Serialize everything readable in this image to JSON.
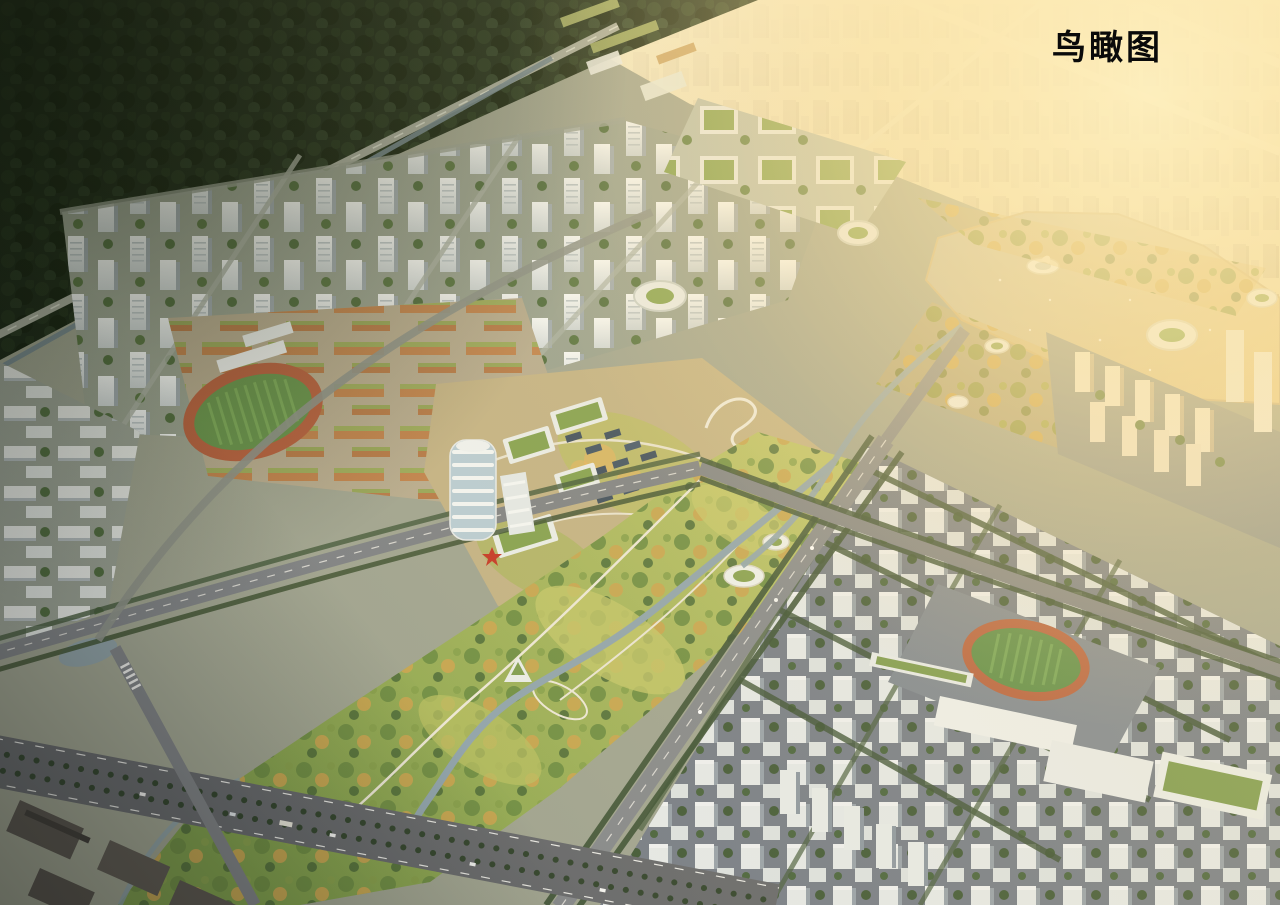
{
  "overlay": {
    "title": "鸟瞰图"
  },
  "palette": {
    "sun_glow": "#ffe3a1",
    "haze_sky": "#efe0b4",
    "forest": "#243420",
    "park_green": "#9fae55",
    "golden_trees": "#c7a44f",
    "lake_water": "#d6bd85",
    "building_white": "#edf0ef",
    "green_roof": "#83a04e",
    "school_orange": "#c07d45",
    "track_red": "#b65f3d",
    "field_green": "#5f8f46",
    "road_gray": "#7c7f82",
    "district_shadow": "#79808a",
    "stream_blue": "#8fa3ac",
    "accent_red": "#c33524",
    "plaza_purple": "#b478dc"
  },
  "regions": [
    {
      "name": "distant-city-haze"
    },
    {
      "name": "forest-belt"
    },
    {
      "name": "highway"
    },
    {
      "name": "canal"
    },
    {
      "name": "north-residential-towers"
    },
    {
      "name": "green-roof-tech-park"
    },
    {
      "name": "school-campus-west"
    },
    {
      "name": "running-track-west"
    },
    {
      "name": "innovation-campus-center"
    },
    {
      "name": "white-tower"
    },
    {
      "name": "historic-village"
    },
    {
      "name": "event-plaza"
    },
    {
      "name": "karting-track"
    },
    {
      "name": "lake"
    },
    {
      "name": "lake-boat-pavilion"
    },
    {
      "name": "lakeside-residential-east"
    },
    {
      "name": "central-greenway"
    },
    {
      "name": "stream"
    },
    {
      "name": "rowhouse-district-southeast"
    },
    {
      "name": "school-campus-southeast"
    },
    {
      "name": "running-track-southeast"
    },
    {
      "name": "arterial-road-southwest"
    },
    {
      "name": "warehouse-district-southwest"
    },
    {
      "name": "caption"
    }
  ]
}
